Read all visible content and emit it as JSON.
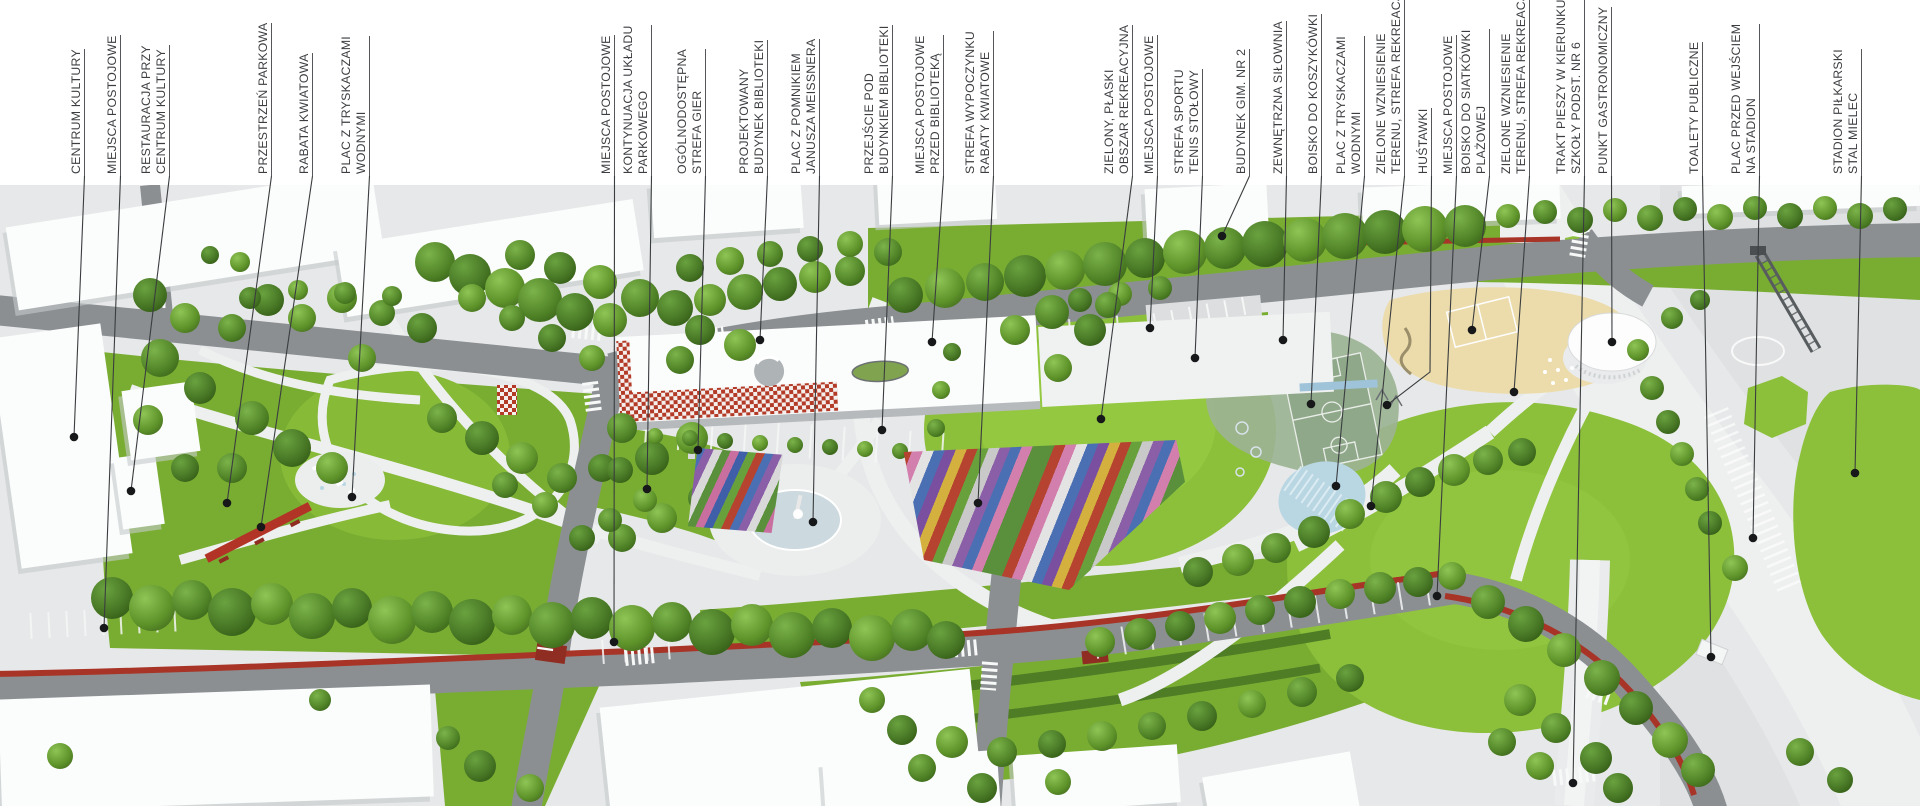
{
  "callouts": [
    {
      "id": "centrum-kultury",
      "lines": [
        "CENTRUM KULTURY"
      ],
      "x": 85,
      "dot": [
        74,
        437
      ]
    },
    {
      "id": "miejsca-postojowe-1",
      "lines": [
        "MIEJSCA POSTOJOWE"
      ],
      "x": 121,
      "dot": [
        104,
        628
      ]
    },
    {
      "id": "restauracja-przy-ck",
      "lines": [
        "RESTAURACJA PRZY",
        "CENTRUM KULTURY"
      ],
      "x": 170,
      "dot": [
        131,
        491
      ]
    },
    {
      "id": "przestrzen-parkowa",
      "lines": [
        "PRZESTRZEŃ PARKOWA"
      ],
      "x": 272,
      "dot": [
        227,
        503
      ]
    },
    {
      "id": "rabata-kwiatowa",
      "lines": [
        "RABATA KWIATOWA"
      ],
      "x": 313,
      "dot": [
        261,
        527
      ]
    },
    {
      "id": "plac-z-tryskaczami-1",
      "lines": [
        "PLAC Z TRYSKACZAMI",
        "WODNYMI"
      ],
      "x": 370,
      "dot": [
        352,
        497
      ]
    },
    {
      "id": "miejsca-postojowe-2",
      "lines": [
        "MIEJSCA POSTOJOWE"
      ],
      "x": 615,
      "dot": [
        614,
        642
      ]
    },
    {
      "id": "kontynuacja-ukladu-parkowego",
      "lines": [
        "KONTYNUACJA UKŁADU",
        "PARKOWEGO"
      ],
      "x": 652,
      "dot": [
        647,
        489
      ]
    },
    {
      "id": "strefa-gier",
      "lines": [
        "OGÓLNODOSTĘPNA",
        "STREFA GIER"
      ],
      "x": 706,
      "dot": [
        698,
        450
      ]
    },
    {
      "id": "budynek-biblioteki",
      "lines": [
        "PROJEKTOWANY",
        "BUDYNEK BIBLIOTEKI"
      ],
      "x": 768,
      "dot": [
        760,
        340
      ]
    },
    {
      "id": "plac-meissnera",
      "lines": [
        "PLAC Z POMNIKIEM",
        "JANUSZA MEISSNERA"
      ],
      "x": 820,
      "dot": [
        813,
        522
      ]
    },
    {
      "id": "przejscie-pod-biblioteka",
      "lines": [
        "PRZEJŚCIE POD",
        "BUDYNKIEM BIBLIOTEKI"
      ],
      "x": 893,
      "dot": [
        882,
        430
      ]
    },
    {
      "id": "miejsca-postojowe-3",
      "lines": [
        "MIEJSCA POSTOJOWE",
        "PRZED BIBLIOTEKĄ"
      ],
      "x": 944,
      "dot": [
        932,
        342
      ]
    },
    {
      "id": "strefa-wypoczynku",
      "lines": [
        "STREFA WYPOCZYNKU",
        "RABATY KWIATOWE"
      ],
      "x": 994,
      "dot": [
        978,
        503
      ]
    },
    {
      "id": "obszar-rekreacyjny",
      "lines": [
        "ZIELONY, PŁASKI",
        "OBSZAR REKREACYJNA"
      ],
      "x": 1133,
      "dot": [
        1101,
        419
      ]
    },
    {
      "id": "miejsca-postojowe-4",
      "lines": [
        "MIEJSCA POSTOJOWE"
      ],
      "x": 1158,
      "dot": [
        1150,
        328
      ]
    },
    {
      "id": "tenis-stolowy",
      "lines": [
        "STREFA SPORTU",
        "TENIS STOŁOWY"
      ],
      "x": 1203,
      "dot": [
        1195,
        358
      ]
    },
    {
      "id": "budynek-gim-nr-2",
      "lines": [
        "BUDYNEK GIM. NR 2"
      ],
      "x": 1250,
      "dot": [
        1222,
        236
      ]
    },
    {
      "id": "zewnetrzna-silownia",
      "lines": [
        "ZEWNĘTRZNA SIŁOWNIA"
      ],
      "x": 1287,
      "dot": [
        1283,
        340
      ]
    },
    {
      "id": "boisko-do-koszykowki",
      "lines": [
        "BOISKO DO KOSZYKÓWKI"
      ],
      "x": 1322,
      "dot": [
        1311,
        404
      ]
    },
    {
      "id": "plac-z-tryskaczami-2",
      "lines": [
        "PLAC Z TRYSKACZAMI",
        "WODNYMI"
      ],
      "x": 1365,
      "dot": [
        1336,
        486
      ]
    },
    {
      "id": "zielone-wzniesienie-1",
      "lines": [
        "ZIELONE WZNIESIENIE",
        "TERENU, STREFA REKREACJI"
      ],
      "x": 1405,
      "dot": [
        1371,
        506
      ]
    },
    {
      "id": "hustawki",
      "lines": [
        "HUŚTAWKI"
      ],
      "x": 1432,
      "dot": [
        1387,
        405
      ],
      "bend": [
        1430,
        372
      ]
    },
    {
      "id": "miejsca-postojowe-5",
      "lines": [
        "MIEJSCA POSTOJOWE"
      ],
      "x": 1457,
      "dot": [
        1437,
        596
      ]
    },
    {
      "id": "siatkowka-plazowa",
      "lines": [
        "BOISKO DO SIATKÓWKI",
        "PLAŻOWEJ"
      ],
      "x": 1490,
      "dot": [
        1472,
        330
      ]
    },
    {
      "id": "zielone-wzniesienie-2",
      "lines": [
        "ZIELONE WZNIESIENIE",
        "TERENU, STREFA REKREACJI"
      ],
      "x": 1530,
      "dot": [
        1514,
        392
      ]
    },
    {
      "id": "trakt-pieszy",
      "lines": [
        "TRAKT PIESZY W KIERUNKU",
        "SZKOŁY PODST. NR 6"
      ],
      "x": 1585,
      "dot": [
        1573,
        783
      ]
    },
    {
      "id": "punkt-gastronomiczny",
      "lines": [
        "PUNKT GASTRONOMICZNY"
      ],
      "x": 1612,
      "dot": [
        1612,
        342
      ]
    },
    {
      "id": "toalety-publiczne",
      "lines": [
        "TOALETY PUBLICZNE"
      ],
      "x": 1703,
      "dot": [
        1711,
        657
      ]
    },
    {
      "id": "plac-przed-stadionem",
      "lines": [
        "PLAC PRZED WEJŚCIEM",
        "NA STADION"
      ],
      "x": 1760,
      "dot": [
        1753,
        538
      ]
    },
    {
      "id": "stadion",
      "lines": [
        "STADION PIŁKARSKI",
        "STAL MIELEC"
      ],
      "x": 1862,
      "dot": [
        1855,
        473
      ]
    }
  ],
  "colors": {
    "label_ink": "#3b3d40",
    "leader_line": "#3a3d3f",
    "dot": "#17181a",
    "lawn": "#8cc03b",
    "park_green": "#79ad32",
    "road": "#8b8f92",
    "paved": "#e7e8e9",
    "plaza": "#eef0f0",
    "building": "#fbfcfc",
    "accent_red": "#a83427",
    "water": "#b9d6e3",
    "pool": "#ccd9de",
    "sand": "#ecdcab",
    "court_green": "#8fa889"
  },
  "flower_bed_small": {
    "colors": [
      "#b5432f",
      "#4a6fb3",
      "#8a5fa8",
      "#d9d9d9",
      "#5a8f3c",
      "#c96fa0",
      "#3f5fa8",
      "#68a03c"
    ]
  },
  "flower_bed_large": {
    "colors": [
      "#5a8f3c",
      "#b5432f",
      "#d27fae",
      "#e3e3e3",
      "#4a6fb3",
      "#7a4fa0",
      "#d4b13f",
      "#b5432f",
      "#68a03c",
      "#c9c9c9",
      "#8a5fa8",
      "#4a6fb3",
      "#d27fae",
      "#5a8f3c"
    ]
  }
}
